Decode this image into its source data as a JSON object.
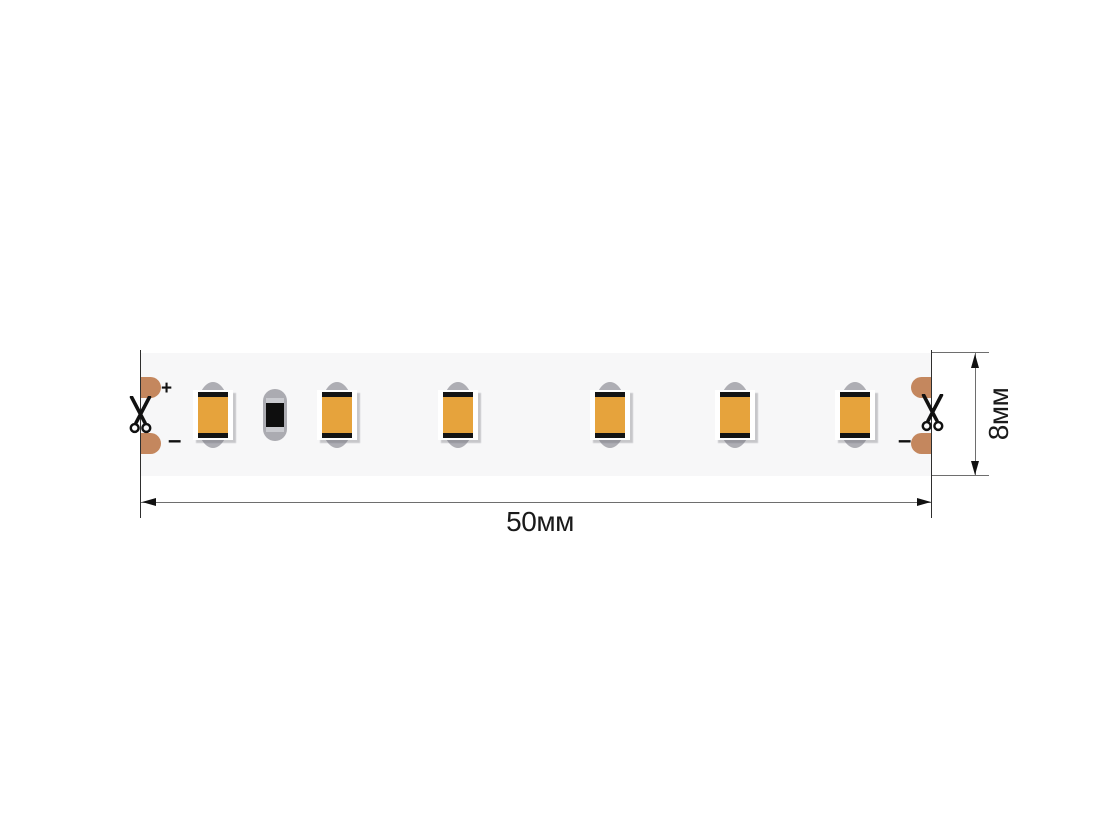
{
  "diagram": {
    "title": "led-strip-dimension-drawing",
    "dimensions": {
      "width_label": "50мм",
      "height_label": "8мм"
    },
    "polarity": {
      "left_plus": "+",
      "left_minus": "–",
      "right_minus": "–"
    },
    "components": {
      "led_centers_x": [
        213,
        337,
        458,
        610,
        735,
        855
      ],
      "led_center_y": 415,
      "resistor_center_x": 275,
      "resistor_center_y": 415
    },
    "colors": {
      "led_chip": "#e6a33c",
      "component_gray": "#aeaeb4",
      "copper_pad": "#c4875e",
      "strip_background": "#f7f7f8",
      "dimension_line": "#6e6e6e",
      "text": "#1a1a1a"
    }
  }
}
